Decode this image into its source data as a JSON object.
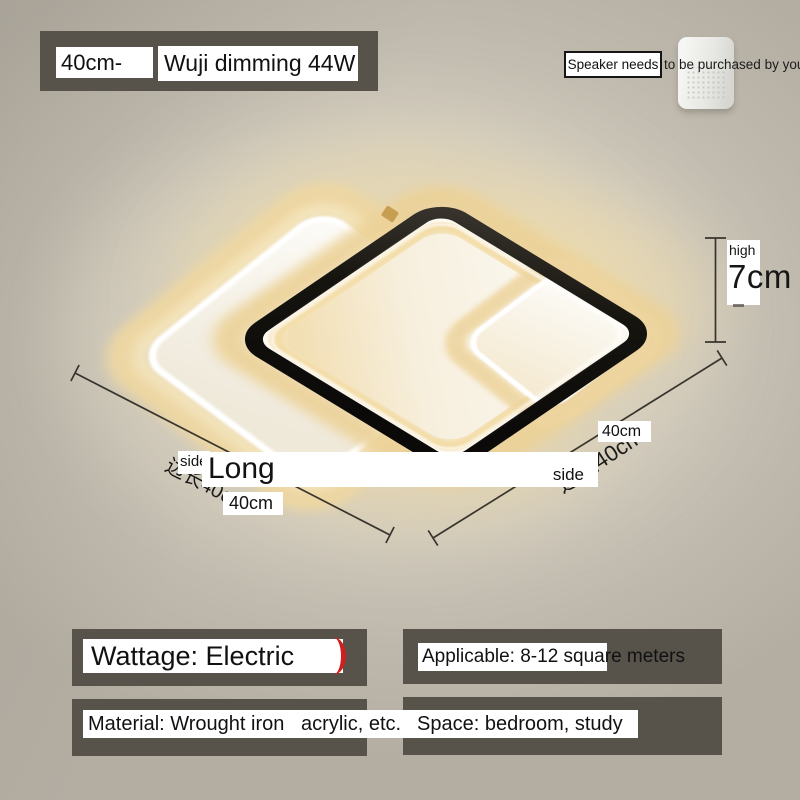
{
  "colors": {
    "background": "#b7b1a6",
    "panel_dark": "#57534b",
    "label_bg": "#ffffff",
    "text": "#161616",
    "accent_red": "#cf1f1f",
    "glow_warm": "#f0dcab",
    "lamp_frame_black": "#12100e"
  },
  "header": {
    "size_tag": "40cm-",
    "model_tag": "Wuji dimming 44W"
  },
  "speaker_note": {
    "boxed_text": "Speaker needs",
    "trailing_text": "to be purchased by yourself"
  },
  "dimension_labels": {
    "height_label": "high",
    "height_value": "7cm",
    "long_label": "Long",
    "long_value_bottom": "40cm",
    "side_label_left": "side",
    "side_label_right": "side",
    "side_value_right": "40cm",
    "rotated_side_length_right": "边长40cm",
    "rotated_side_length_left": "边长40cm"
  },
  "specs": [
    {
      "id": "wattage",
      "text": "Wattage: Electric"
    },
    {
      "id": "applicable",
      "text": "Applicable: 8-12 square meters"
    },
    {
      "id": "material",
      "text": "Material: Wrought iron   acrylic, etc."
    },
    {
      "id": "space",
      "text": "Space: bedroom, study"
    }
  ]
}
